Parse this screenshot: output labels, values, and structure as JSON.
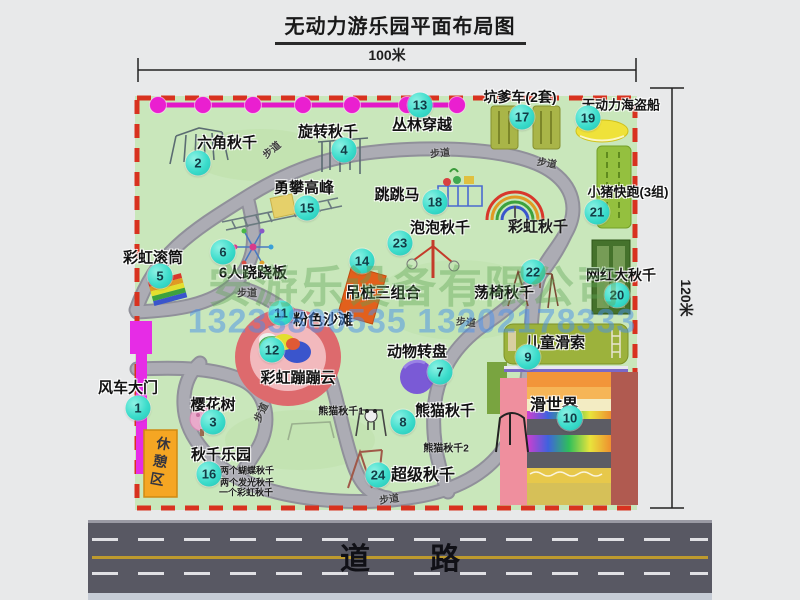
{
  "title": "无动力游乐园平面布局图",
  "dims": {
    "top": "100米",
    "right": "120米"
  },
  "road": {
    "label": "道　　路"
  },
  "watermark": {
    "company": "安游乐设备有限公司",
    "phones": "13233800535 13202178333"
  },
  "colors": {
    "park_green": "#c9e7bb",
    "path_gray": "#a6a6ac",
    "border_red": "#d8321f",
    "badge_teal": "#3bdccb",
    "zipline_magenta": "#e318c8",
    "gate_magenta": "#e62ce6",
    "rest_orange": "#f5a623",
    "road_gray": "#585863",
    "watermark_green": "#60a454",
    "watermark_blue": "#4890eb"
  },
  "park": {
    "path_label_text": "步道",
    "rest_area_label": "休憩区",
    "markers": [
      {
        "num": "1",
        "name": "风车大门",
        "bx": 138,
        "by": 408,
        "lx": 128,
        "ly": 387
      },
      {
        "num": "2",
        "name": "六角秋千",
        "bx": 198,
        "by": 163,
        "lx": 227,
        "ly": 142
      },
      {
        "num": "3",
        "name": "樱花树",
        "bx": 213,
        "by": 422,
        "lx": 213,
        "ly": 404
      },
      {
        "num": "4",
        "name": "旋转秋千",
        "bx": 344,
        "by": 150,
        "lx": 328,
        "ly": 131
      },
      {
        "num": "5",
        "name": "彩虹滚筒",
        "bx": 160,
        "by": 276,
        "lx": 153,
        "ly": 257
      },
      {
        "num": "6",
        "name": "6人跷跷板",
        "bx": 223,
        "by": 252,
        "lx": 253,
        "ly": 272
      },
      {
        "num": "7",
        "name": "动物转盘",
        "bx": 440,
        "by": 372,
        "lx": 417,
        "ly": 351
      },
      {
        "num": "8",
        "name": "熊猫秋千",
        "bx": 403,
        "by": 422,
        "lx": 445,
        "ly": 410
      },
      {
        "num": "9",
        "name": "儿童滑索",
        "bx": 528,
        "by": 357,
        "lx": 555,
        "ly": 342
      },
      {
        "num": "10",
        "name": "滑世界",
        "bx": 570,
        "by": 418,
        "lx": 554,
        "ly": 403,
        "fs": 16
      },
      {
        "num": "11",
        "name": "粉色沙滩",
        "bx": 281,
        "by": 313,
        "lx": 323,
        "ly": 319
      },
      {
        "num": "12",
        "name": "彩虹蹦蹦云",
        "bx": 272,
        "by": 350,
        "lx": 298,
        "ly": 377
      },
      {
        "num": "13",
        "name": "丛林穿越",
        "bx": 420,
        "by": 105,
        "lx": 422,
        "ly": 124
      },
      {
        "num": "14",
        "name": "吊桩三组合",
        "bx": 362,
        "by": 261,
        "lx": 383,
        "ly": 292
      },
      {
        "num": "15",
        "name": "勇攀高峰",
        "bx": 307,
        "by": 208,
        "lx": 304,
        "ly": 187
      },
      {
        "num": "16",
        "name": "秋千乐园",
        "bx": 209,
        "by": 474,
        "lx": 221,
        "ly": 454
      },
      {
        "num": "17",
        "name": "坑爹车(2套)",
        "bx": 522,
        "by": 117,
        "lx": 520,
        "ly": 97,
        "fs": 14
      },
      {
        "num": "18",
        "name": "跳跳马",
        "bx": 435,
        "by": 202,
        "lx": 397,
        "ly": 194
      },
      {
        "num": "19",
        "name": "无动力海盗船",
        "bx": 588,
        "by": 118,
        "lx": 621,
        "ly": 104,
        "fs": 13
      },
      {
        "num": "20",
        "name": "网红大秋千",
        "bx": 617,
        "by": 295,
        "lx": 621,
        "ly": 275,
        "fs": 14
      },
      {
        "num": "21",
        "name": "小猪快跑(3组)",
        "bx": 597,
        "by": 212,
        "lx": 628,
        "ly": 191,
        "fs": 13
      },
      {
        "num": "22",
        "name": "荡椅秋千",
        "bx": 533,
        "by": 272,
        "lx": 504,
        "ly": 292
      },
      {
        "num": "23",
        "name": "泡泡秋千",
        "bx": 400,
        "by": 243,
        "lx": 440,
        "ly": 227
      },
      {
        "num": "24",
        "name": "超级秋千",
        "bx": 378,
        "by": 475,
        "lx": 423,
        "ly": 473,
        "fs": 16
      }
    ],
    "extra_labels": [
      {
        "text": "彩虹秋千",
        "x": 538,
        "y": 226,
        "fs": 15
      },
      {
        "text": "熊猫秋千1",
        "x": 341,
        "y": 410,
        "fs": 10
      },
      {
        "text": "熊猫秋千2",
        "x": 446,
        "y": 447,
        "fs": 10
      },
      {
        "text": "两个蝴蝶秋千",
        "x": 247,
        "y": 470,
        "fs": 9
      },
      {
        "text": "两个发光秋千",
        "x": 247,
        "y": 482,
        "fs": 9
      },
      {
        "text": "一个彩虹秋千",
        "x": 246,
        "y": 492,
        "fs": 9
      }
    ],
    "path_labels": [
      {
        "x": 271,
        "y": 149,
        "rot": -40
      },
      {
        "x": 440,
        "y": 152,
        "rot": -5
      },
      {
        "x": 547,
        "y": 162,
        "rot": 10
      },
      {
        "x": 247,
        "y": 292,
        "rot": 0
      },
      {
        "x": 466,
        "y": 321,
        "rot": 5
      },
      {
        "x": 260,
        "y": 412,
        "rot": -65
      },
      {
        "x": 389,
        "y": 498,
        "rot": -8
      }
    ]
  }
}
